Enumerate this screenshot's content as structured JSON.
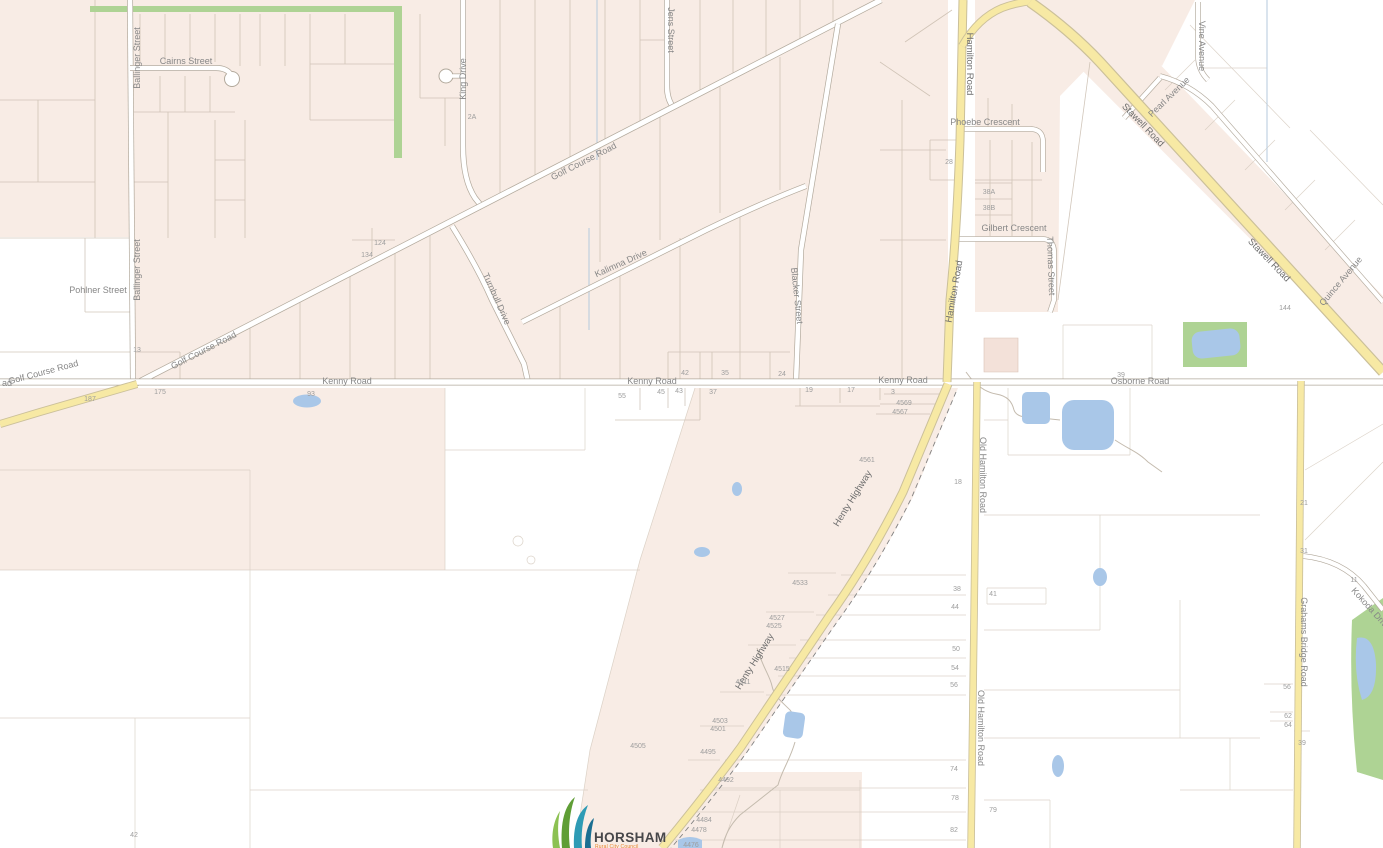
{
  "app": {
    "type": "council-gis-map-viewer",
    "locality": "Horsham"
  },
  "colors": {
    "zone_residential_pink": "#f8ece5",
    "zone_highlight_salmon": "#f3e1d9",
    "highway_fill": "#f7e9a4",
    "highway_casing": "#cbc09a",
    "road_casing": "#b2a99c",
    "road_fill": "#ffffff",
    "water": "#a9c7e8",
    "reserve_green": "#aed394",
    "label_gray": "#878787"
  },
  "streets": {
    "ballinger": "Ballinger Street",
    "cairns": "Cairns Street",
    "pohlner": "Pohlner Street",
    "king": "King Drive",
    "jens": "Jens Street",
    "golf_course": "Golf Course Road",
    "kalimna": "Kalimna Drive",
    "turnbull": "Turnbull Drive",
    "blacker": "Blacker Street",
    "kenny": "Kenny Road",
    "osborne": "Osborne Road",
    "hamilton": "Hamilton Road",
    "old_hamilton": "Old Hamilton Road",
    "henty": "Henty Highway",
    "stawell": "Stawell Road",
    "phoebe": "Phoebe Crescent",
    "gilbert": "Gilbert Crescent",
    "thomas": "Thomas Street",
    "pearl": "Pearl Avenue",
    "vine": "Vine Avenue",
    "quince": "Quince Avenue",
    "grahams_bridge": "Grahams Bridge Road",
    "kokoda": "Kokoda Drive",
    "west_fragment": "ad"
  },
  "parcel_numbers": {
    "n124": "124",
    "n134": "134",
    "n13": "13",
    "n2a": "2A",
    "n28": "28",
    "n38a": "38A",
    "n38b": "38B",
    "n144": "144",
    "n187": "187",
    "n175": "175",
    "n93": "93",
    "n42": "42",
    "n35": "35",
    "n24": "24",
    "n55": "55",
    "n45": "45",
    "n43": "43",
    "n37": "37",
    "n19": "19",
    "n17": "17",
    "n3": "3",
    "n39": "39",
    "n4569": "4569",
    "n4567": "4567",
    "n4561": "4561",
    "n18": "18",
    "n4533": "4533",
    "n4527": "4527",
    "n4525": "4525",
    "n4515": "4515",
    "n4511": "4511",
    "n4505": "4505",
    "n4503": "4503",
    "n4501": "4501",
    "n4495": "4495",
    "n4492": "4492",
    "n4484": "4484",
    "n4478": "4478",
    "n4476": "4476",
    "n38": "38",
    "n44": "44",
    "n50": "50",
    "n54": "54",
    "n56": "56",
    "n74": "74",
    "n78": "78",
    "n82": "82",
    "n41": "41",
    "n79": "79",
    "n21": "21",
    "n31": "31",
    "n11": "11",
    "n56b": "56",
    "n62": "62",
    "n64": "64",
    "n39b": "39",
    "n42b": "42"
  },
  "logo": {
    "name": "HORSHAM",
    "subtitle": "Rural City Council"
  }
}
